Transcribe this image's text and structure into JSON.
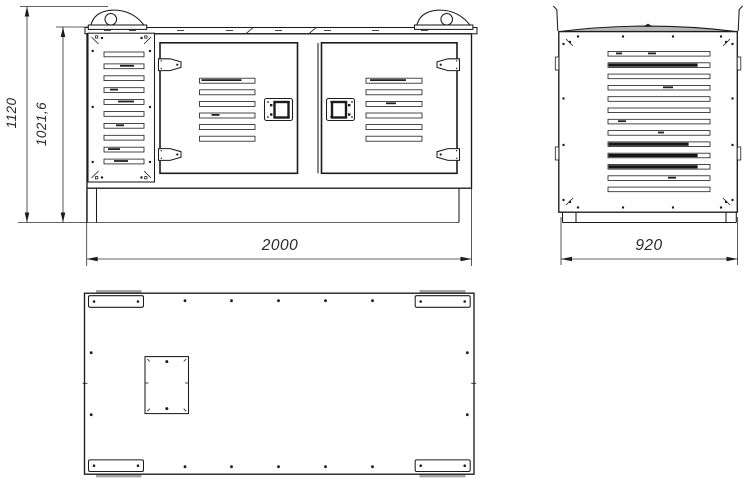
{
  "drawing": {
    "kind": "technical-three-view-drawing",
    "line_color": "#1c1c1c",
    "shade_color": "#a4a4a4",
    "views": {
      "front": {
        "dim_height_overall": "1120",
        "dim_height_body": "1021,6",
        "dim_width": "2000",
        "louver_panel_slats": 10,
        "door_louver_slats": 6,
        "doors": 2,
        "lifting_eyes": 2
      },
      "side": {
        "dim_width": "920",
        "louver_slats": 13
      },
      "bottom": {
        "corner_foot_plates": 4,
        "edge_holes_top_row": 5,
        "edge_holes_bottom_row": 5
      }
    }
  }
}
